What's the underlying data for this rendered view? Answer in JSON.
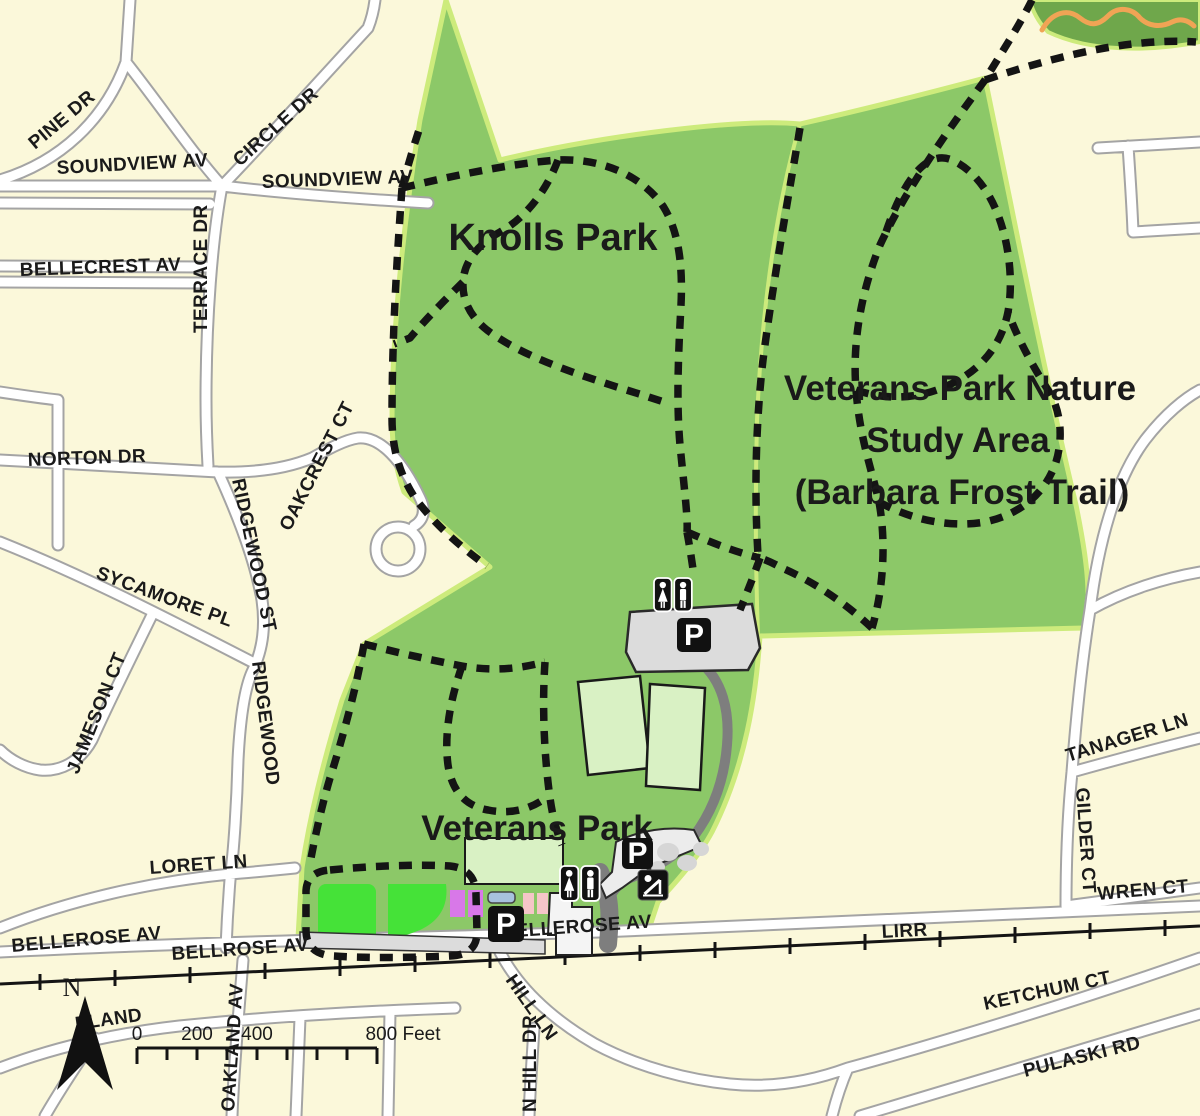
{
  "colors": {
    "background": "#FBF8DA",
    "park_green": "#8CC868",
    "park_border": "#CDEB7C",
    "dark_green_patch": "#6FA74B",
    "orange_trail": "#F0A455",
    "trail_black": "#141414",
    "road_fill": "#FFFFFF",
    "road_casing": "#A4A4A4",
    "field_light_green": "#D9F1C4",
    "field_bright_green": "#45E238",
    "court_purple": "#D878E8",
    "court_pink": "#F5C6C8",
    "pool_blue": "#A8C2DE",
    "parking_gray": "#DCDCDC",
    "driveway_gray": "#7E7E7E",
    "text": "#1A1A1A"
  },
  "park_labels": {
    "knolls": "Knolls Park",
    "nature1": "Veterans Park Nature",
    "nature2": "Study Area",
    "nature3": "(Barbara Frost Trail)",
    "veterans": "Veterans Park"
  },
  "streets": {
    "pine_dr": "PINE DR",
    "soundview_av_w": "SOUNDVIEW AV",
    "circle_dr": "CIRCLE DR",
    "soundview_av_e": "SOUNDVIEW AV",
    "terrace_dr": "TERRACE DR",
    "bellecrest_av": "BELLECREST AV",
    "norton_dr": "NORTON DR",
    "oakcrest_ct": "OAKCREST CT",
    "ridgewood_st": "RIDGEWOOD ST",
    "sycamore_pl": "SYCAMORE PL",
    "jameson_ct": "JAMESON CT",
    "ridgewood": "RIDGEWOOD",
    "loret_ln": "LORET LN",
    "bellerose_av_w": "BELLEROSE AV",
    "bellrose_av": "BELLROSE AV",
    "bellerose_av_c": "BELLEROSE AV",
    "lirr": "LIRR",
    "wren_ct": "WREN CT",
    "tanager_ln": "TANAGER LN",
    "gilder_ct": "GILDER CT",
    "ketchum_ct": "KETCHUM CT",
    "pulaski_rd": "PULASKI RD",
    "hill_ln": "HILL LN",
    "n_hill_dr": "N HILL DR",
    "oakland_av": "OAKLAND AV",
    "eland": "ELAND"
  },
  "compass": {
    "north": "N"
  },
  "scale_bar": {
    "t0": "0",
    "t200": "200",
    "t400": "400",
    "t800": "800 Feet"
  },
  "icons": {
    "parking_letter": "P",
    "restroom": "restroom-icon",
    "playground": "playground-icon",
    "north_arrow": "north-arrow-icon"
  }
}
